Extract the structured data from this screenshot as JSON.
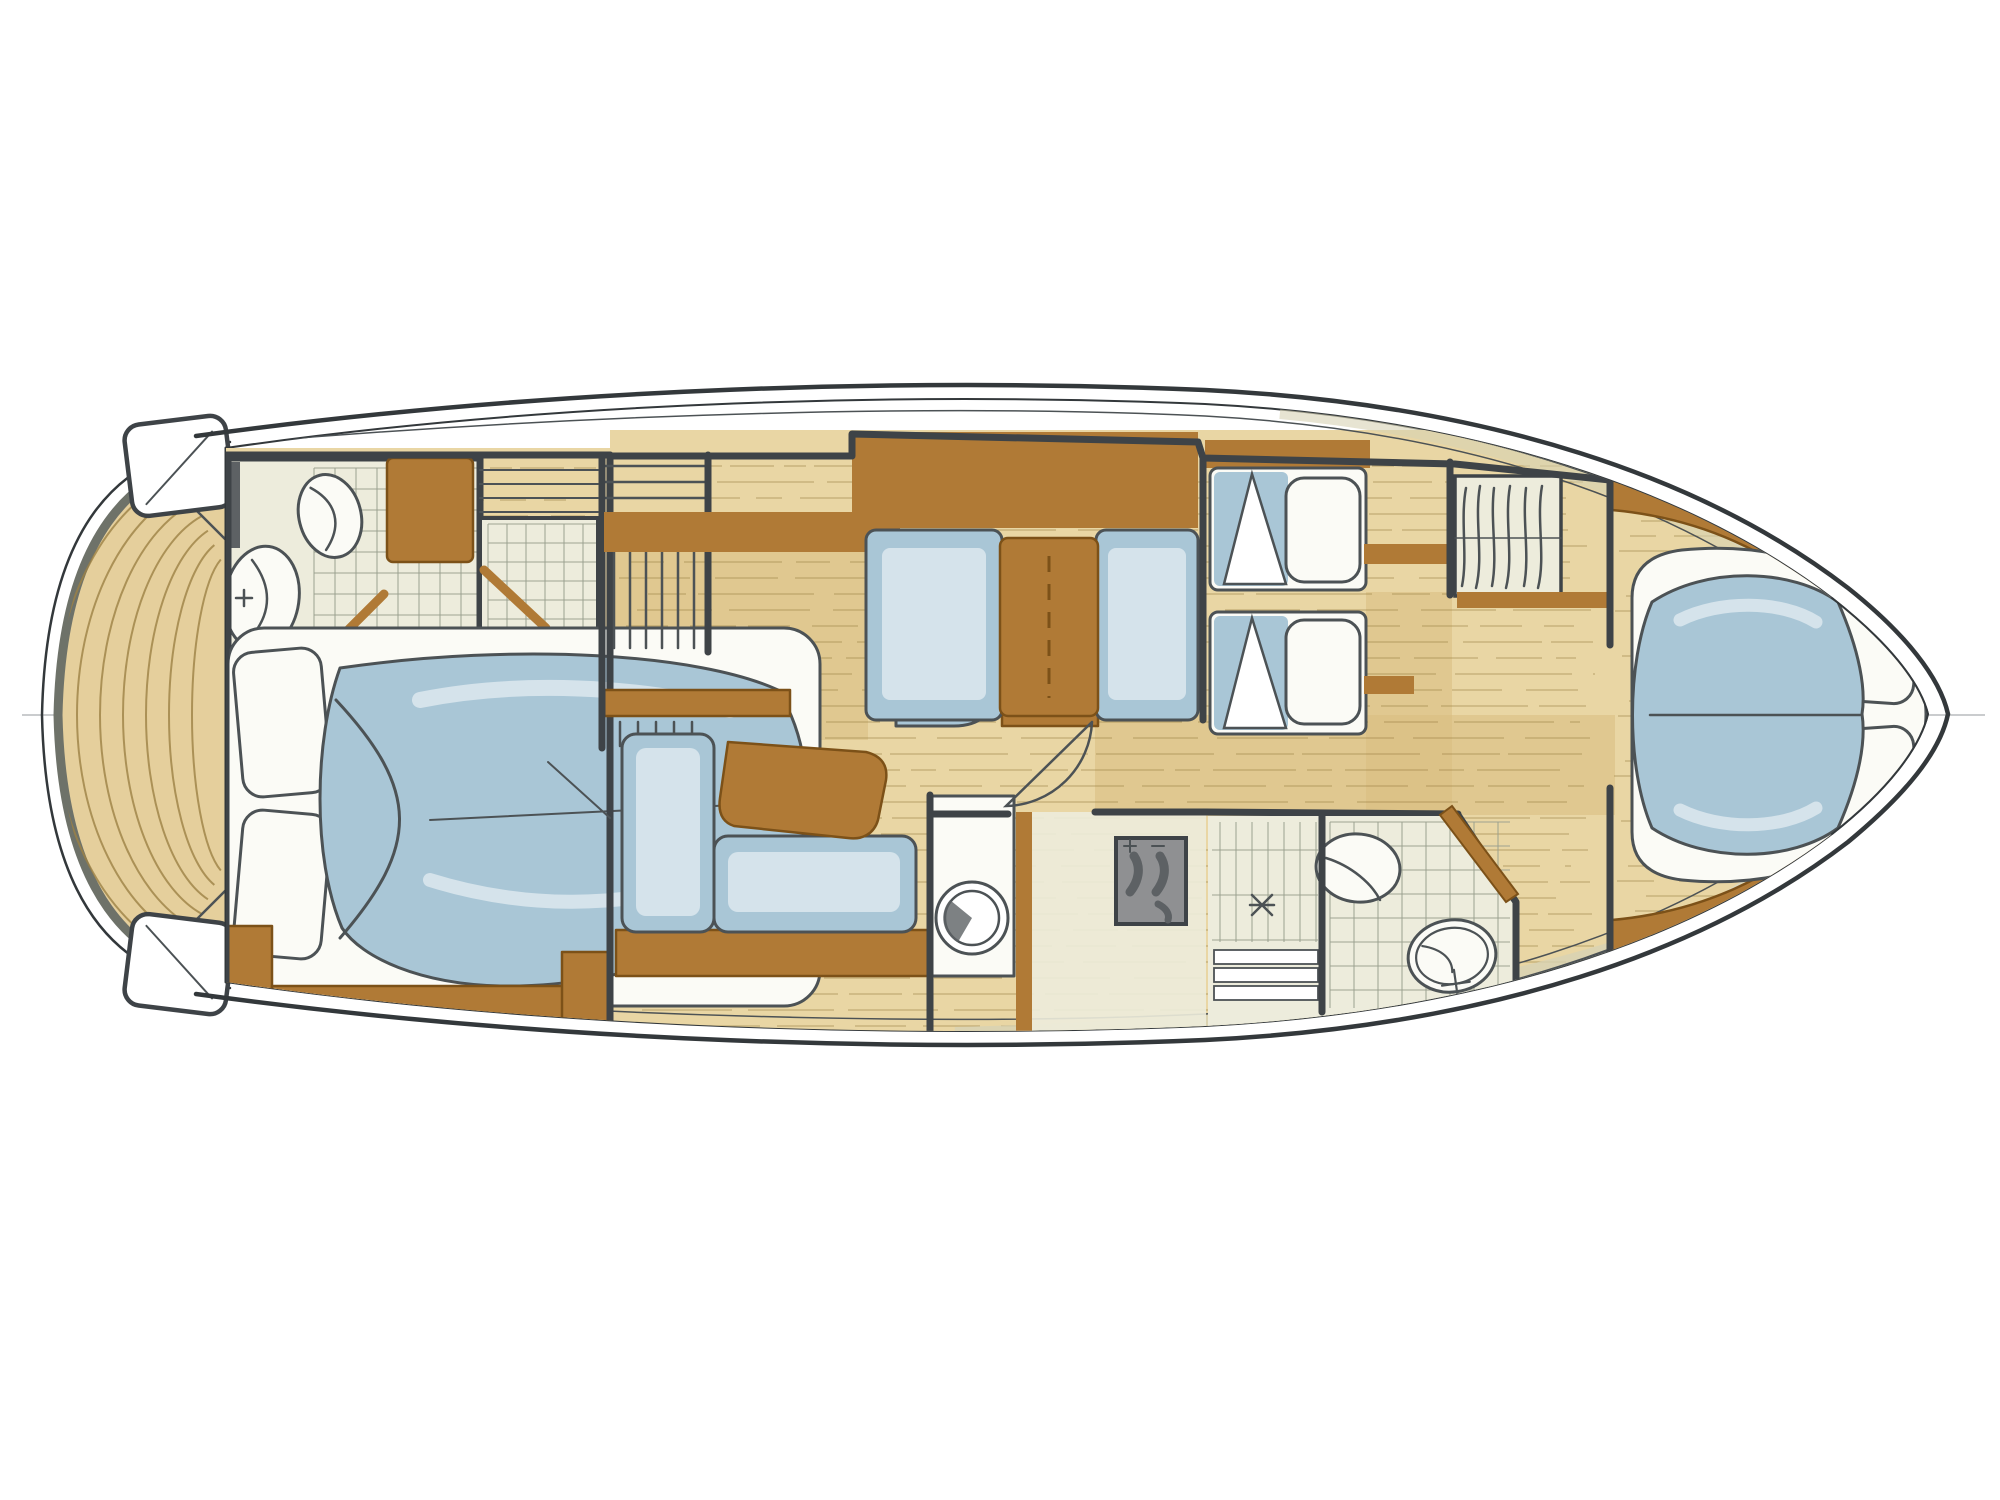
{
  "document": {
    "title": "Motor yacht interior layout plan",
    "description": "Hand-drawn marker and watercolour floor plan of a motor yacht, top view, bow pointing right, showing aft owner's cabin, salon with dinette, galley, two bathrooms, midship guest cabin and forward V-berth cabin",
    "drawing_style": "pencil and marker sketch with watercolour wash",
    "orientation": "bow to the right, stern with swim platform to the left"
  },
  "palette": {
    "paper": "#ffffff",
    "wood": "#e9d6a4",
    "woodLine": "#9c8145",
    "walkway": "#d9bd80",
    "brown": "#b07a36",
    "brownDark": "#7c5118",
    "blue": "#a9c6d6",
    "blueDeep": "#86aec5",
    "blueLight": "#d5e3eb",
    "white": "#fbfbf6",
    "tile": "#edecdc",
    "tileLine": "#9aa08e",
    "wall": "#3e4347",
    "pencil": "#4c5255",
    "gray": "#8f9092",
    "grayDark": "#5d6164",
    "platform": "#e5cf9c",
    "platformRim": "#6e7269",
    "hullStroke": "#33383b",
    "hullBeige": "#d7d2b4",
    "faint": "#b9bcbe"
  },
  "vessel": {
    "sections": [
      {
        "name": "swim platform",
        "features": [
          "curved teak planking",
          "boarding step port corner",
          "boarding step starboard corner",
          "transom"
        ]
      },
      {
        "name": "aft owners cabin",
        "features": [
          "double bed with blue duvet",
          "two pillows",
          "en-suite bathroom with washbasin and toilet",
          "tiled shower cabin with glass door",
          "wardrobe",
          "dark locker",
          "side shelf",
          "L-shaped cabinetry at foot of bed"
        ]
      },
      {
        "name": "companionway",
        "features": [
          "upper stair flight",
          "lower stair flight",
          "wooden hand rail edge",
          "door to aft cabin"
        ]
      },
      {
        "name": "salon",
        "features": [
          "L-shaped settee in blue upholstery",
          "wooden coffee table",
          "companion seat",
          "storage cabinet",
          "long sideboard"
        ]
      },
      {
        "name": "dinette",
        "features": [
          "two facing bench seats",
          "wooden table with centre leaf",
          "sideboard above"
        ]
      },
      {
        "name": "galley",
        "features": [
          "counter with round sink",
          "two-burner stove",
          "storage cabinets",
          "access door"
        ]
      },
      {
        "name": "midship guest cabin",
        "features": [
          "two single berths with white pillows",
          "folded duvets",
          "bedside shelves",
          "head-board shelf",
          "hanging locker with clothes"
        ]
      },
      {
        "name": "forward bathroom",
        "features": [
          "shower with teak grating and drain",
          "washbasin",
          "toilet",
          "tiled floor",
          "angled entry door"
        ]
      },
      {
        "name": "bow cabin",
        "features": [
          "V-shaped double berth with blue duvet",
          "two pillows at bow end",
          "curved hull-side cabinetry",
          "hanging locker",
          "bulkhead doorway"
        ]
      },
      {
        "name": "hull structure",
        "features": [
          "double sheer line",
          "side decks",
          "centreline",
          "frame station line",
          "transom curves"
        ]
      }
    ]
  }
}
